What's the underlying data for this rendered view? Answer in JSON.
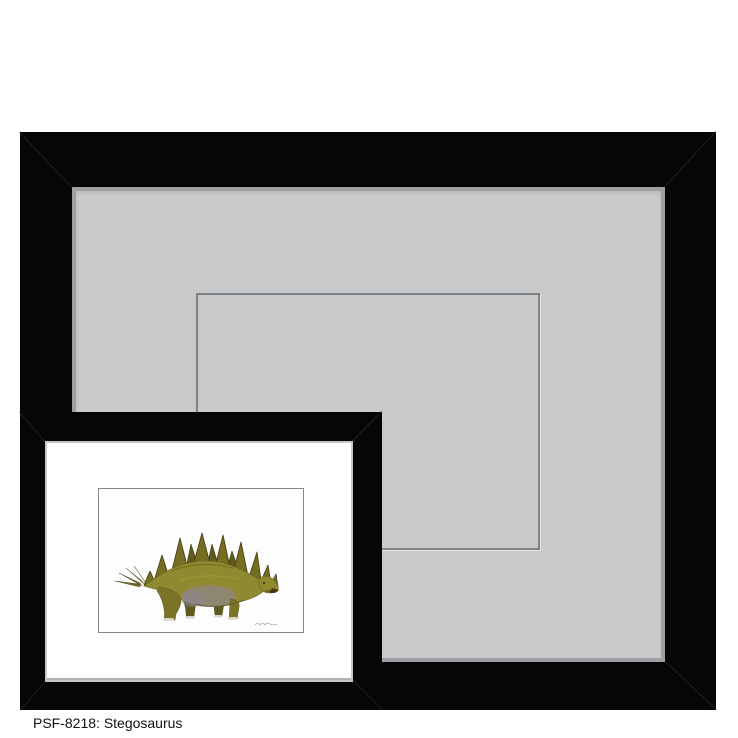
{
  "caption": {
    "sku": "PSF-8218",
    "subject": "Stegosaurus",
    "text": "PSF-8218: Stegosaurus"
  },
  "frames": {
    "large": {
      "molding_color_name": "black",
      "mat_color_name": "gray"
    },
    "inset": {
      "molding_color_name": "black",
      "mat_color_name": "white",
      "artwork_subject": "Stegosaurus"
    }
  },
  "colors": {
    "frame_black": "#060606",
    "miter_line": "#242424",
    "mat_gray": "#c8c9cb",
    "mat_lip": "#9da0a2",
    "opening_line": "#7e8285",
    "inset_mat_white": "#ffffff",
    "inset_mat_lip": "#c4c6c8",
    "artwork_bg": "#fdfdfd",
    "artwork_border": "#85888b",
    "caption_color": "#101010",
    "dino_body": "#8f8a2f",
    "dino_dark": "#5f5a1d",
    "dino_plate": "#756d22",
    "dino_plate_dark": "#433a10",
    "dino_belly": "#8d8594",
    "dino_claw": "#d9d6c9",
    "signature_gray": "#a8adb0"
  }
}
